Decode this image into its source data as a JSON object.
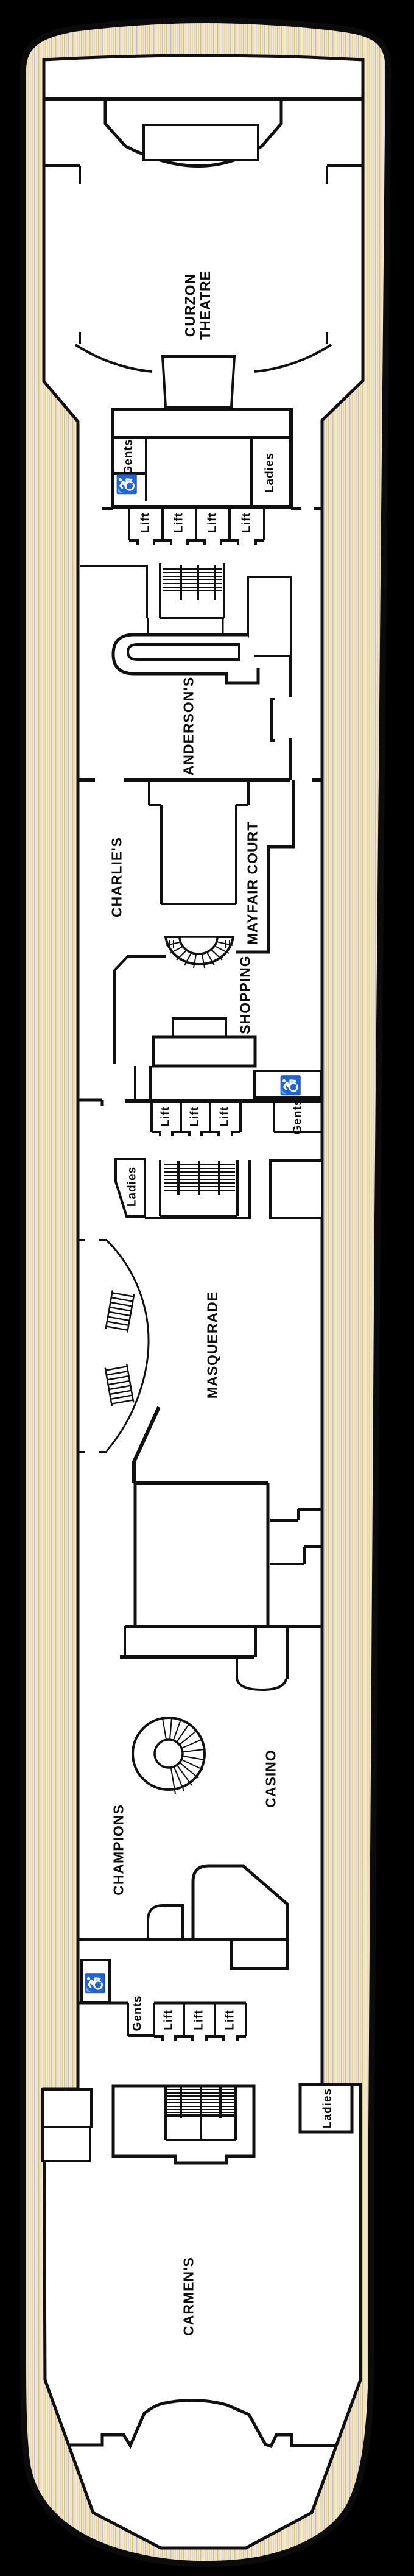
{
  "plan": {
    "description": "Cruise ship deck plan, bow at top, stern at bottom",
    "colors": {
      "background": "#000000",
      "deck_base": "#f8e9c6",
      "deck_stripe_gray": "#b9c0cc",
      "deck_stripe_tan": "#e9d2a0",
      "interior": "#ffffff",
      "walls": "#101010"
    },
    "venues": [
      {
        "id": "curzon-theatre",
        "label": "CURZON THEATRE",
        "label_lines": [
          "CURZON",
          "THEATRE"
        ]
      },
      {
        "id": "andersons",
        "label": "ANDERSON'S"
      },
      {
        "id": "charlies",
        "label": "CHARLIE'S"
      },
      {
        "id": "mayfair-court",
        "label": "MAYFAIR COURT"
      },
      {
        "id": "shopping",
        "label": "SHOPPING"
      },
      {
        "id": "masquerade",
        "label": "MASQUERADE"
      },
      {
        "id": "casino",
        "label": "CASINO"
      },
      {
        "id": "champions",
        "label": "CHAMPIONS"
      },
      {
        "id": "carmens",
        "label": "CARMEN'S"
      }
    ],
    "facilities": {
      "gents": [
        {
          "label": "Gents"
        },
        {
          "label": "Gents"
        },
        {
          "label": "Gents"
        }
      ],
      "ladies": [
        {
          "label": "Ladies"
        },
        {
          "label": "Ladies"
        },
        {
          "label": "Ladies"
        }
      ],
      "lifts": [
        {
          "label": "Lift"
        },
        {
          "label": "Lift"
        },
        {
          "label": "Lift"
        },
        {
          "label": "Lift"
        },
        {
          "label": "Lift"
        },
        {
          "label": "Lift"
        },
        {
          "label": "Lift"
        },
        {
          "label": "Lift"
        },
        {
          "label": "Lift"
        },
        {
          "label": "Lift"
        }
      ],
      "accessible_wc_count": 3
    },
    "icons": {
      "wheelchair_glyph": "♿"
    }
  }
}
